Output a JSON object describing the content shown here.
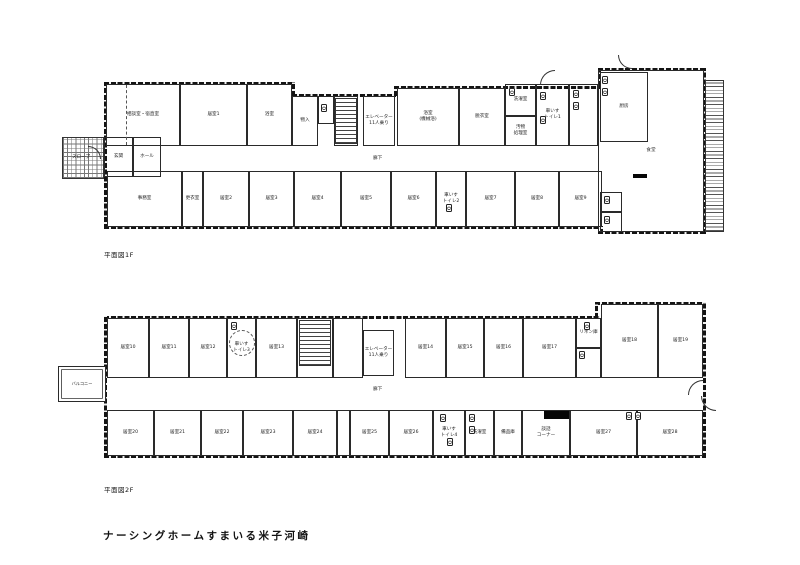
{
  "title": "ナーシングホームすまいる米子河崎",
  "floors": [
    {
      "caption": "平面図1F",
      "corridor_label": "廊下",
      "walls": [
        {
          "x": 104,
          "y": 82,
          "w": 190,
          "h": 2.6,
          "d": "h"
        },
        {
          "x": 292,
          "y": 82,
          "w": 2.6,
          "h": 14,
          "d": "v"
        },
        {
          "x": 292,
          "y": 94,
          "w": 104,
          "h": 2.6,
          "d": "h"
        },
        {
          "x": 394,
          "y": 86,
          "w": 2.6,
          "h": 10,
          "d": "v"
        },
        {
          "x": 394,
          "y": 86,
          "w": 206,
          "h": 2.6,
          "d": "h"
        },
        {
          "x": 598,
          "y": 68,
          "w": 108,
          "h": 2.6,
          "d": "h"
        },
        {
          "x": 598,
          "y": 68,
          "w": 2.6,
          "h": 18,
          "d": "v"
        },
        {
          "x": 104,
          "y": 82,
          "w": 2.6,
          "h": 147,
          "d": "v"
        },
        {
          "x": 104,
          "y": 226,
          "w": 498,
          "h": 2.6,
          "d": "h"
        },
        {
          "x": 600,
          "y": 226,
          "w": 2.6,
          "h": 8,
          "d": "v"
        },
        {
          "x": 598,
          "y": 231,
          "w": 108,
          "h": 2.6,
          "d": "h"
        },
        {
          "x": 703,
          "y": 68,
          "w": 2.6,
          "h": 166,
          "d": "v"
        }
      ],
      "hatches": [
        {
          "x": 62,
          "y": 137,
          "w": 42,
          "h": 42,
          "t": "grid"
        },
        {
          "x": 705,
          "y": 80,
          "w": 19,
          "h": 152,
          "t": "ladder"
        },
        {
          "x": 335,
          "y": 98,
          "w": 22,
          "h": 46,
          "t": "stairs"
        }
      ],
      "rooms": [
        {
          "x": 598,
          "y": 70,
          "w": 106,
          "h": 162,
          "label": "食堂"
        },
        {
          "x": 600,
          "y": 72,
          "w": 48,
          "h": 70,
          "label": "厨房"
        },
        {
          "x": 600,
          "y": 192,
          "w": 22,
          "h": 20,
          "label": ""
        },
        {
          "x": 600,
          "y": 212,
          "w": 22,
          "h": 20,
          "label": ""
        },
        {
          "x": 106,
          "y": 84,
          "w": 74,
          "h": 62,
          "label": "相談室・宿直室"
        },
        {
          "x": 180,
          "y": 84,
          "w": 67,
          "h": 62,
          "label": "居室1"
        },
        {
          "x": 247,
          "y": 84,
          "w": 45,
          "h": 62,
          "label": "浴室"
        },
        {
          "x": 292,
          "y": 96,
          "w": 26,
          "h": 50,
          "label": "物入"
        },
        {
          "x": 318,
          "y": 96,
          "w": 16,
          "h": 28,
          "label": ""
        },
        {
          "x": 334,
          "y": 96,
          "w": 24,
          "h": 50,
          "label": ""
        },
        {
          "x": 363,
          "y": 96,
          "w": 32,
          "h": 50,
          "label": "エレベーター\n11人乗り"
        },
        {
          "x": 397,
          "y": 88,
          "w": 62,
          "h": 58,
          "label": "浴室\n(機械浴)"
        },
        {
          "x": 459,
          "y": 88,
          "w": 46,
          "h": 58,
          "label": "脱衣室"
        },
        {
          "x": 505,
          "y": 84,
          "w": 31,
          "h": 32,
          "label": "洗濯室"
        },
        {
          "x": 505,
          "y": 116,
          "w": 31,
          "h": 30,
          "label": "汚物\n処理室"
        },
        {
          "x": 536,
          "y": 84,
          "w": 33,
          "h": 62,
          "label": "車いす\nトイレ1"
        },
        {
          "x": 569,
          "y": 84,
          "w": 29,
          "h": 62,
          "label": ""
        },
        {
          "x": 104,
          "y": 137,
          "w": 29,
          "h": 40,
          "label": "玄関"
        },
        {
          "x": 133,
          "y": 137,
          "w": 28,
          "h": 40,
          "label": "ホール"
        },
        {
          "x": 107,
          "y": 171,
          "w": 75,
          "h": 56,
          "label": "事務室"
        },
        {
          "x": 182,
          "y": 171,
          "w": 21,
          "h": 56,
          "label": "更衣室"
        },
        {
          "x": 203,
          "y": 171,
          "w": 46,
          "h": 56,
          "label": "居室2"
        },
        {
          "x": 249,
          "y": 171,
          "w": 45,
          "h": 56,
          "label": "居室3"
        },
        {
          "x": 294,
          "y": 171,
          "w": 47,
          "h": 56,
          "label": "居室4"
        },
        {
          "x": 341,
          "y": 171,
          "w": 50,
          "h": 56,
          "label": "居室5"
        },
        {
          "x": 391,
          "y": 171,
          "w": 45,
          "h": 56,
          "label": "居室6"
        },
        {
          "x": 436,
          "y": 171,
          "w": 30,
          "h": 56,
          "label": "車いす\nトイレ2"
        },
        {
          "x": 466,
          "y": 171,
          "w": 49,
          "h": 56,
          "label": "居室7"
        },
        {
          "x": 515,
          "y": 171,
          "w": 44,
          "h": 56,
          "label": "居室8"
        },
        {
          "x": 559,
          "y": 171,
          "w": 43,
          "h": 56,
          "label": "居室9"
        }
      ],
      "fixtures": [
        {
          "x": 321,
          "y": 104,
          "t": "toilet"
        },
        {
          "x": 540,
          "y": 92,
          "t": "toilet"
        },
        {
          "x": 540,
          "y": 116,
          "t": "toilet"
        },
        {
          "x": 446,
          "y": 204,
          "t": "toilet"
        },
        {
          "x": 604,
          "y": 196,
          "t": "toilet"
        },
        {
          "x": 604,
          "y": 216,
          "t": "toilet"
        },
        {
          "x": 573,
          "y": 90,
          "t": "washer"
        },
        {
          "x": 573,
          "y": 102,
          "t": "washer"
        },
        {
          "x": 509,
          "y": 88,
          "t": "washer"
        },
        {
          "x": 602,
          "y": 76,
          "t": "washer"
        },
        {
          "x": 602,
          "y": 88,
          "t": "washer"
        }
      ],
      "solids": [
        {
          "x": 633,
          "y": 174,
          "w": 14,
          "h": 4
        }
      ],
      "arcs": [
        {
          "x": 540,
          "y": 70,
          "r": 15,
          "o": "tl"
        },
        {
          "x": 618,
          "y": 55,
          "r": 14,
          "o": "bl"
        },
        {
          "x": 88,
          "y": 146,
          "r": 13,
          "o": "tr"
        }
      ],
      "dashes": [
        {
          "x": 126,
          "y": 85,
          "h": 60
        }
      ],
      "circles": [],
      "labels": [
        {
          "x": 373,
          "y": 155,
          "text": "廊下"
        },
        {
          "x": 72,
          "y": 154,
          "text": "スロープ"
        }
      ]
    },
    {
      "caption": "平面図2F",
      "corridor_label": "廊下",
      "walls": [
        {
          "x": 104,
          "y": 316,
          "w": 496,
          "h": 2.6,
          "d": "h"
        },
        {
          "x": 595,
          "y": 302,
          "w": 111,
          "h": 2.6,
          "d": "h"
        },
        {
          "x": 595,
          "y": 302,
          "w": 2.6,
          "h": 16,
          "d": "v"
        },
        {
          "x": 104,
          "y": 316,
          "w": 2.6,
          "h": 142,
          "d": "v"
        },
        {
          "x": 104,
          "y": 455,
          "w": 500,
          "h": 2.6,
          "d": "h"
        },
        {
          "x": 600,
          "y": 455,
          "w": 106,
          "h": 2.6,
          "d": "h"
        },
        {
          "x": 703,
          "y": 302,
          "w": 2.6,
          "h": 156,
          "d": "v"
        }
      ],
      "hatches": [
        {
          "x": 299,
          "y": 320,
          "w": 32,
          "h": 46,
          "t": "stairs"
        }
      ],
      "rooms": [
        {
          "x": 58,
          "y": 366,
          "w": 48,
          "h": 36,
          "label": "バルコニー",
          "cls": "balcony"
        },
        {
          "x": 107,
          "y": 318,
          "w": 42,
          "h": 60,
          "label": "居室10"
        },
        {
          "x": 149,
          "y": 318,
          "w": 40,
          "h": 60,
          "label": "居室11"
        },
        {
          "x": 189,
          "y": 318,
          "w": 38,
          "h": 60,
          "label": "居室12"
        },
        {
          "x": 227,
          "y": 318,
          "w": 29,
          "h": 60,
          "label": "車いす\nトイレ3"
        },
        {
          "x": 256,
          "y": 318,
          "w": 41,
          "h": 60,
          "label": "居室13"
        },
        {
          "x": 297,
          "y": 318,
          "w": 36,
          "h": 60,
          "label": ""
        },
        {
          "x": 333,
          "y": 318,
          "w": 30,
          "h": 60,
          "label": ""
        },
        {
          "x": 363,
          "y": 330,
          "w": 31,
          "h": 46,
          "label": "エレベーター\n11人乗り"
        },
        {
          "x": 405,
          "y": 318,
          "w": 41,
          "h": 60,
          "label": "居室14"
        },
        {
          "x": 446,
          "y": 318,
          "w": 38,
          "h": 60,
          "label": "居室15"
        },
        {
          "x": 484,
          "y": 318,
          "w": 39,
          "h": 60,
          "label": "居室16"
        },
        {
          "x": 523,
          "y": 318,
          "w": 53,
          "h": 60,
          "label": "居室17"
        },
        {
          "x": 576,
          "y": 318,
          "w": 25,
          "h": 30,
          "label": "リネン庫"
        },
        {
          "x": 576,
          "y": 348,
          "w": 25,
          "h": 30,
          "label": ""
        },
        {
          "x": 601,
          "y": 304,
          "w": 57,
          "h": 74,
          "label": "居室18"
        },
        {
          "x": 658,
          "y": 304,
          "w": 45,
          "h": 74,
          "label": "居室19"
        },
        {
          "x": 107,
          "y": 410,
          "w": 47,
          "h": 46,
          "label": "居室20"
        },
        {
          "x": 154,
          "y": 410,
          "w": 47,
          "h": 46,
          "label": "居室21"
        },
        {
          "x": 201,
          "y": 410,
          "w": 42,
          "h": 46,
          "label": "居室22"
        },
        {
          "x": 243,
          "y": 410,
          "w": 50,
          "h": 46,
          "label": "居室23"
        },
        {
          "x": 293,
          "y": 410,
          "w": 44,
          "h": 46,
          "label": "居室24"
        },
        {
          "x": 337,
          "y": 410,
          "w": 13,
          "h": 46,
          "label": ""
        },
        {
          "x": 350,
          "y": 410,
          "w": 39,
          "h": 46,
          "label": "居室25"
        },
        {
          "x": 389,
          "y": 410,
          "w": 44,
          "h": 46,
          "label": "居室26"
        },
        {
          "x": 433,
          "y": 410,
          "w": 32,
          "h": 46,
          "label": "車いす\nトイレ4"
        },
        {
          "x": 465,
          "y": 410,
          "w": 29,
          "h": 46,
          "label": "洗濯室"
        },
        {
          "x": 494,
          "y": 410,
          "w": 28,
          "h": 46,
          "label": "備品庫"
        },
        {
          "x": 522,
          "y": 410,
          "w": 48,
          "h": 46,
          "label": "談話\nコーナー"
        },
        {
          "x": 570,
          "y": 410,
          "w": 67,
          "h": 46,
          "label": "居室27"
        },
        {
          "x": 637,
          "y": 410,
          "w": 66,
          "h": 46,
          "label": "居室28"
        }
      ],
      "fixtures": [
        {
          "x": 231,
          "y": 322,
          "t": "toilet"
        },
        {
          "x": 584,
          "y": 322,
          "t": "toilet"
        },
        {
          "x": 579,
          "y": 351,
          "t": "washer"
        },
        {
          "x": 447,
          "y": 438,
          "t": "toilet"
        },
        {
          "x": 440,
          "y": 414,
          "t": "washer"
        },
        {
          "x": 469,
          "y": 414,
          "t": "washer"
        },
        {
          "x": 469,
          "y": 426,
          "t": "washer"
        },
        {
          "x": 626,
          "y": 412,
          "t": "toilet"
        },
        {
          "x": 635,
          "y": 412,
          "t": "toilet"
        }
      ],
      "solids": [
        {
          "x": 544,
          "y": 411,
          "w": 25,
          "h": 8
        }
      ],
      "arcs": [
        {
          "x": 688,
          "y": 380,
          "r": 15,
          "o": "tl"
        },
        {
          "x": 701,
          "y": 396,
          "r": 15,
          "o": "bl"
        }
      ],
      "dashes": [],
      "circles": [
        {
          "x": 229,
          "y": 330,
          "d": 26
        }
      ],
      "labels": [
        {
          "x": 373,
          "y": 386,
          "text": "廊下"
        }
      ]
    }
  ]
}
